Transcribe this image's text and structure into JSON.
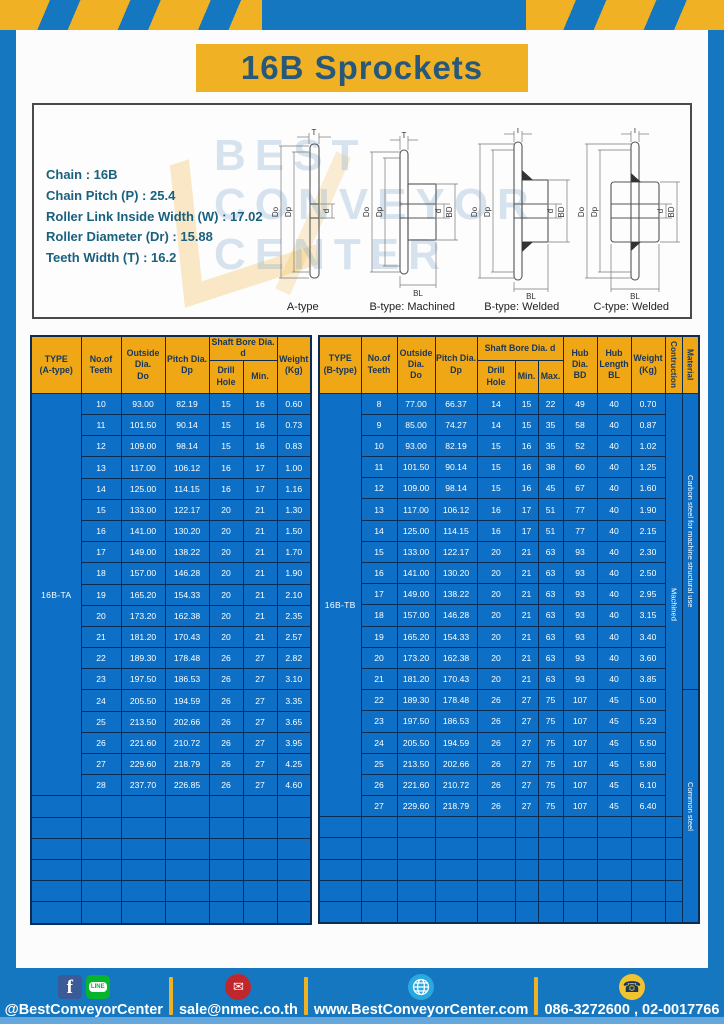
{
  "page": {
    "title": "16B Sprockets"
  },
  "specs": {
    "lines": [
      "Chain : 16B",
      "Chain Pitch (P) : 25.4",
      "Roller Link Inside Width (W) : 17.02",
      "Roller Diameter (Dr) : 15.88",
      "Teeth Width (T) : 16.2"
    ]
  },
  "diagrams": {
    "captions": [
      "A-type",
      "B-type: Machined",
      "B-type: Welded",
      "C-type: Welded"
    ],
    "dims": {
      "t": "T",
      "outer": "Do",
      "pitch": "Dp",
      "bore": "d",
      "hub": "BD",
      "hublen": "BL"
    },
    "watermark_lines": [
      "BEST",
      "CONVEYOR",
      "CENTER"
    ]
  },
  "table_a": {
    "type_label": "16B-TA",
    "headers": {
      "type_l1": "TYPE",
      "type_l2": "(A-type)",
      "teeth_l1": "No.of",
      "teeth_l2": "Teeth",
      "outside_l1": "Outside",
      "outside_l2": "Dia.",
      "outside_l3": "Do",
      "pitch_l1": "Pitch Dia.",
      "pitch_l2": "Dp",
      "shaft_group": "Shaft Bore Dia. d",
      "drill": "Drill Hole",
      "min": "Min.",
      "weight_l1": "Weight",
      "weight_l2": "(Kg)"
    },
    "rows": [
      [
        "10",
        "93.00",
        "82.19",
        "15",
        "16",
        "0.60"
      ],
      [
        "11",
        "101.50",
        "90.14",
        "15",
        "16",
        "0.73"
      ],
      [
        "12",
        "109.00",
        "98.14",
        "15",
        "16",
        "0.83"
      ],
      [
        "13",
        "117.00",
        "106.12",
        "16",
        "17",
        "1.00"
      ],
      [
        "14",
        "125.00",
        "114.15",
        "16",
        "17",
        "1.16"
      ],
      [
        "15",
        "133.00",
        "122.17",
        "20",
        "21",
        "1.30"
      ],
      [
        "16",
        "141.00",
        "130.20",
        "20",
        "21",
        "1.50"
      ],
      [
        "17",
        "149.00",
        "138.22",
        "20",
        "21",
        "1.70"
      ],
      [
        "18",
        "157.00",
        "146.28",
        "20",
        "21",
        "1.90"
      ],
      [
        "19",
        "165.20",
        "154.33",
        "20",
        "21",
        "2.10"
      ],
      [
        "20",
        "173.20",
        "162.38",
        "20",
        "21",
        "2.35"
      ],
      [
        "21",
        "181.20",
        "170.43",
        "20",
        "21",
        "2.57"
      ],
      [
        "22",
        "189.30",
        "178.48",
        "26",
        "27",
        "2.82"
      ],
      [
        "23",
        "197.50",
        "186.53",
        "26",
        "27",
        "3.10"
      ],
      [
        "24",
        "205.50",
        "194.59",
        "26",
        "27",
        "3.35"
      ],
      [
        "25",
        "213.50",
        "202.66",
        "26",
        "27",
        "3.65"
      ],
      [
        "26",
        "221.60",
        "210.72",
        "26",
        "27",
        "3.95"
      ],
      [
        "27",
        "229.60",
        "218.79",
        "26",
        "27",
        "4.25"
      ],
      [
        "28",
        "237.70",
        "226.85",
        "26",
        "27",
        "4.60"
      ]
    ],
    "empty_rows": 6
  },
  "table_b": {
    "type_label": "16B-TB",
    "headers": {
      "type_l1": "TYPE",
      "type_l2": "(B-type)",
      "teeth_l1": "No.of",
      "teeth_l2": "Teeth",
      "outside_l1": "Outside",
      "outside_l2": "Dia.",
      "outside_l3": "Do",
      "pitch_l1": "Pitch Dia.",
      "pitch_l2": "Dp",
      "shaft_group": "Shaft Bore Dia. d",
      "drill": "Drill Hole",
      "min": "Min.",
      "max": "Max.",
      "hub_dia_l1": "Hub Dia.",
      "hub_dia_l2": "BD",
      "hub_len_l1": "Hub",
      "hub_len_l2": "Length",
      "hub_len_l3": "BL",
      "weight_l1": "Weight",
      "weight_l2": "(Kg)",
      "construction": "Contruction",
      "material": "Material"
    },
    "rows": [
      [
        "8",
        "77.00",
        "66.37",
        "14",
        "15",
        "22",
        "49",
        "40",
        "0.70"
      ],
      [
        "9",
        "85.00",
        "74.27",
        "14",
        "15",
        "35",
        "58",
        "40",
        "0.87"
      ],
      [
        "10",
        "93.00",
        "82.19",
        "15",
        "16",
        "35",
        "52",
        "40",
        "1.02"
      ],
      [
        "11",
        "101.50",
        "90.14",
        "15",
        "16",
        "38",
        "60",
        "40",
        "1.25"
      ],
      [
        "12",
        "109.00",
        "98.14",
        "15",
        "16",
        "45",
        "67",
        "40",
        "1.60"
      ],
      [
        "13",
        "117.00",
        "106.12",
        "16",
        "17",
        "51",
        "77",
        "40",
        "1.90"
      ],
      [
        "14",
        "125.00",
        "114.15",
        "16",
        "17",
        "51",
        "77",
        "40",
        "2.15"
      ],
      [
        "15",
        "133.00",
        "122.17",
        "20",
        "21",
        "63",
        "93",
        "40",
        "2.30"
      ],
      [
        "16",
        "141.00",
        "130.20",
        "20",
        "21",
        "63",
        "93",
        "40",
        "2.50"
      ],
      [
        "17",
        "149.00",
        "138.22",
        "20",
        "21",
        "63",
        "93",
        "40",
        "2.95"
      ],
      [
        "18",
        "157.00",
        "146.28",
        "20",
        "21",
        "63",
        "93",
        "40",
        "3.15"
      ],
      [
        "19",
        "165.20",
        "154.33",
        "20",
        "21",
        "63",
        "93",
        "40",
        "3.40"
      ],
      [
        "20",
        "173.20",
        "162.38",
        "20",
        "21",
        "63",
        "93",
        "40",
        "3.60"
      ],
      [
        "21",
        "181.20",
        "170.43",
        "20",
        "21",
        "63",
        "93",
        "40",
        "3.85"
      ],
      [
        "22",
        "189.30",
        "178.48",
        "26",
        "27",
        "75",
        "107",
        "45",
        "5.00"
      ],
      [
        "23",
        "197.50",
        "186.53",
        "26",
        "27",
        "75",
        "107",
        "45",
        "5.23"
      ],
      [
        "24",
        "205.50",
        "194.59",
        "26",
        "27",
        "75",
        "107",
        "45",
        "5.50"
      ],
      [
        "25",
        "213.50",
        "202.66",
        "26",
        "27",
        "75",
        "107",
        "45",
        "5.80"
      ],
      [
        "26",
        "221.60",
        "210.72",
        "26",
        "27",
        "75",
        "107",
        "45",
        "6.10"
      ],
      [
        "27",
        "229.60",
        "218.79",
        "26",
        "27",
        "75",
        "107",
        "45",
        "6.40"
      ]
    ],
    "construction_value": "Machined",
    "materials": [
      {
        "label": "Carbon steel for machine structural use",
        "span": 14
      },
      {
        "label": "Common steel",
        "span": 11
      }
    ],
    "empty_rows": 5
  },
  "footer": {
    "social_handle": "@BestConveyorCenter",
    "email": "sale@nmec.co.th",
    "website": "www.BestConveyorCenter.com",
    "phones": "086-3272600 , 02-0017766",
    "line_label": "LINE"
  },
  "colors": {
    "frame_blue": "#1577c0",
    "banner_yellow": "#f0b125",
    "table_header_yellow": "#efa716",
    "cell_blue": "#0d70c6",
    "grid_navy": "#0b2d55",
    "title_teal": "#27587a",
    "footer_light_strip": "#66a7db"
  }
}
